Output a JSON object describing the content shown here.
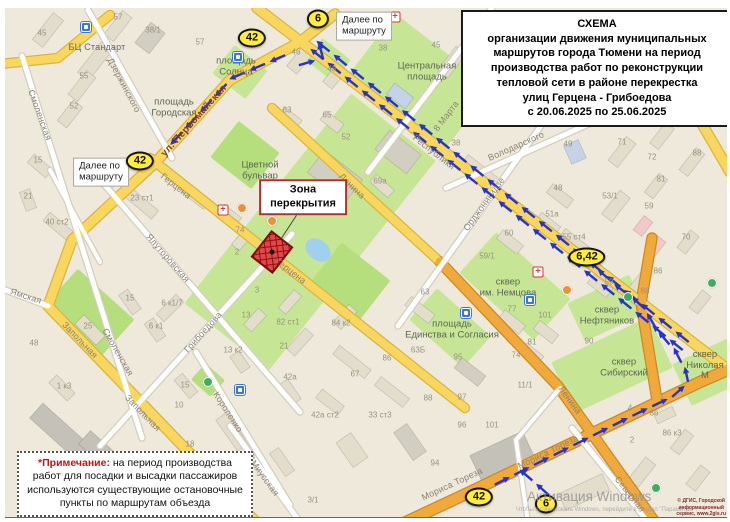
{
  "title_box": {
    "text": "СХЕМА\nорганизации движения муниципальных\nмаршрутов города Тюмени на период\nпроизводства работ по реконструкции\nтепловой сети в районе перекрестка\nулиц Герцена - Грибоедова\nс 20.06.2025 по 25.06.2025"
  },
  "note_box": {
    "label": "*Примечание:",
    "text": " на период производства работ для посадки и высадки пассажиров используются существующие остановочные пункты по маршрутам объезда"
  },
  "zone_label": {
    "text": "Зона\nперекрытия"
  },
  "watermark": {
    "line1": "Активация Windows",
    "line2": "Чтобы активировать Windows, перейдите в раздел \"Параметры\"."
  },
  "copyright": {
    "text": "© ДГИС, Городской\nинформационный\nсервис, www.2gis.ru"
  },
  "colors": {
    "route_blue": "#2633cc",
    "badge_yellow": "#ffec3d",
    "zone_red": "#e04848",
    "zone_hatch": "#8f0f0f",
    "road_yellow": "#f9d75e",
    "road_orange": "#f2a93c",
    "park_green": "#c6e696"
  },
  "route_badges": [
    {
      "t": "42",
      "x": 252,
      "y": 38
    },
    {
      "t": "6",
      "x": 318,
      "y": 19
    },
    {
      "t": "42",
      "x": 140,
      "y": 161
    },
    {
      "t": "6,42",
      "x": 587,
      "y": 257
    },
    {
      "t": "42",
      "x": 479,
      "y": 497
    },
    {
      "t": "6",
      "x": 546,
      "y": 504
    }
  ],
  "info_boxes": [
    {
      "t": "Далее по\nмаршруту",
      "x": 364,
      "y": 26
    },
    {
      "t": "Далее по\nмаршруту",
      "x": 101,
      "y": 172
    }
  ],
  "street_labels": [
    {
      "t": "Дзержинского",
      "x": 124,
      "y": 85,
      "rot": 62
    },
    {
      "t": "Смоленская",
      "x": 40,
      "y": 115,
      "rot": 70
    },
    {
      "t": "Смоленская",
      "x": 118,
      "y": 352,
      "rot": 60
    },
    {
      "t": "ул. Первомайская",
      "x": 194,
      "y": 121,
      "rot": -48,
      "cls": "main"
    },
    {
      "t": "Герцена",
      "x": 176,
      "y": 186,
      "rot": 38
    },
    {
      "t": "Герцена",
      "x": 291,
      "y": 271,
      "rot": 38
    },
    {
      "t": "Ялуторовская",
      "x": 168,
      "y": 258,
      "rot": 49
    },
    {
      "t": "Грибоедова",
      "x": 203,
      "y": 332,
      "rot": -48
    },
    {
      "t": "Короленко",
      "x": 228,
      "y": 412,
      "rot": 57
    },
    {
      "t": "Запольная",
      "x": 80,
      "y": 340,
      "rot": 46
    },
    {
      "t": "Запольная",
      "x": 143,
      "y": 413,
      "rot": 46
    },
    {
      "t": "Ямская",
      "x": 26,
      "y": 296,
      "rot": 18
    },
    {
      "t": "Республики",
      "x": 434,
      "y": 152,
      "rot": 38
    },
    {
      "t": "Ленина",
      "x": 352,
      "y": 186,
      "rot": 44
    },
    {
      "t": "Ленина",
      "x": 570,
      "y": 400,
      "rot": 54
    },
    {
      "t": "8 Марта",
      "x": 446,
      "y": 116,
      "rot": -53
    },
    {
      "t": "Орджоникидзе",
      "x": 484,
      "y": 204,
      "rot": -54
    },
    {
      "t": "Володарского",
      "x": 516,
      "y": 146,
      "rot": -24
    },
    {
      "t": "Мориса Тореза",
      "x": 452,
      "y": 484,
      "rot": -25
    },
    {
      "t": "Мориса Тореза",
      "x": 548,
      "y": 452,
      "rot": -26
    },
    {
      "t": "Северная",
      "x": 630,
      "y": 494,
      "rot": 51
    },
    {
      "t": "Миусская",
      "x": 265,
      "y": 478,
      "rot": 54
    },
    {
      "t": "БЦ Стандарт",
      "x": 97,
      "y": 47,
      "rot": 0,
      "cls": "poi-name"
    }
  ],
  "area_labels": [
    {
      "t": "площадь\nСолнца",
      "x": 236,
      "y": 67
    },
    {
      "t": "площадь\nГородская",
      "x": 174,
      "y": 108
    },
    {
      "t": "Центральная\nплощадь",
      "x": 427,
      "y": 72
    },
    {
      "t": "Цветной\nбульвар",
      "x": 260,
      "y": 171
    },
    {
      "t": "сквер\nим. Немцова",
      "x": 508,
      "y": 288
    },
    {
      "t": "площадь\nЕдинства и Согласия",
      "x": 452,
      "y": 330
    },
    {
      "t": "сквер\nНефтяников",
      "x": 607,
      "y": 316
    },
    {
      "t": "сквер\nСибирский",
      "x": 624,
      "y": 368
    },
    {
      "t": "сквер\nНиколая М",
      "x": 705,
      "y": 366
    }
  ],
  "house_numbers": [
    {
      "t": "45",
      "x": 42,
      "y": 33
    },
    {
      "t": "57",
      "x": 118,
      "y": 17
    },
    {
      "t": "38/1",
      "x": 153,
      "y": 30
    },
    {
      "t": "55",
      "x": 84,
      "y": 76
    },
    {
      "t": "52",
      "x": 74,
      "y": 106
    },
    {
      "t": "15",
      "x": 38,
      "y": 160
    },
    {
      "t": "34",
      "x": 101,
      "y": 174
    },
    {
      "t": "23 ст1",
      "x": 142,
      "y": 198
    },
    {
      "t": "40 ст2",
      "x": 57,
      "y": 222
    },
    {
      "t": "21",
      "x": 28,
      "y": 196
    },
    {
      "t": "25",
      "x": 88,
      "y": 326
    },
    {
      "t": "48",
      "x": 34,
      "y": 343
    },
    {
      "t": "1 к3",
      "x": 64,
      "y": 386
    },
    {
      "t": "15",
      "x": 130,
      "y": 298
    },
    {
      "t": "6 к1/7",
      "x": 172,
      "y": 303
    },
    {
      "t": "6 к1",
      "x": 156,
      "y": 326
    },
    {
      "t": "15",
      "x": 185,
      "y": 385
    },
    {
      "t": "10",
      "x": 179,
      "y": 405
    },
    {
      "t": "18",
      "x": 190,
      "y": 444
    },
    {
      "t": "57",
      "x": 200,
      "y": 42
    },
    {
      "t": "46",
      "x": 296,
      "y": 52
    },
    {
      "t": "48",
      "x": 332,
      "y": 69
    },
    {
      "t": "63",
      "x": 287,
      "y": 110
    },
    {
      "t": "65",
      "x": 327,
      "y": 115
    },
    {
      "t": "38",
      "x": 383,
      "y": 48
    },
    {
      "t": "45",
      "x": 436,
      "y": 45
    },
    {
      "t": "52",
      "x": 346,
      "y": 137
    },
    {
      "t": "69а",
      "x": 380,
      "y": 181
    },
    {
      "t": "38",
      "x": 456,
      "y": 143
    },
    {
      "t": "49",
      "x": 568,
      "y": 144
    },
    {
      "t": "71",
      "x": 622,
      "y": 142
    },
    {
      "t": "71",
      "x": 705,
      "y": 123
    },
    {
      "t": "72",
      "x": 652,
      "y": 157
    },
    {
      "t": "88",
      "x": 697,
      "y": 153
    },
    {
      "t": "81",
      "x": 661,
      "y": 179
    },
    {
      "t": "53/1",
      "x": 610,
      "y": 196
    },
    {
      "t": "59",
      "x": 649,
      "y": 206
    },
    {
      "t": "70",
      "x": 686,
      "y": 237
    },
    {
      "t": "48",
      "x": 558,
      "y": 188
    },
    {
      "t": "51а",
      "x": 552,
      "y": 214
    },
    {
      "t": "55 ст4",
      "x": 574,
      "y": 237
    },
    {
      "t": "60",
      "x": 509,
      "y": 233
    },
    {
      "t": "59/1",
      "x": 487,
      "y": 256
    },
    {
      "t": "59",
      "x": 609,
      "y": 282
    },
    {
      "t": "86",
      "x": 658,
      "y": 271
    },
    {
      "t": "88",
      "x": 645,
      "y": 291
    },
    {
      "t": "90",
      "x": 589,
      "y": 341
    },
    {
      "t": "74",
      "x": 240,
      "y": 230
    },
    {
      "t": "2",
      "x": 237,
      "y": 252
    },
    {
      "t": "3",
      "x": 257,
      "y": 290
    },
    {
      "t": "74",
      "x": 516,
      "y": 355
    },
    {
      "t": "77",
      "x": 512,
      "y": 309
    },
    {
      "t": "101",
      "x": 545,
      "y": 315
    },
    {
      "t": "81",
      "x": 532,
      "y": 342
    },
    {
      "t": "63",
      "x": 425,
      "y": 292
    },
    {
      "t": "63Б",
      "x": 418,
      "y": 350
    },
    {
      "t": "95",
      "x": 458,
      "y": 357
    },
    {
      "t": "96",
      "x": 462,
      "y": 425
    },
    {
      "t": "97",
      "x": 462,
      "y": 397
    },
    {
      "t": "101",
      "x": 492,
      "y": 425
    },
    {
      "t": "11/1",
      "x": 525,
      "y": 385
    },
    {
      "t": "67",
      "x": 355,
      "y": 374
    },
    {
      "t": "86",
      "x": 387,
      "y": 358
    },
    {
      "t": "88",
      "x": 428,
      "y": 398
    },
    {
      "t": "33 ст3",
      "x": 380,
      "y": 415
    },
    {
      "t": "42а ст2",
      "x": 325,
      "y": 415
    },
    {
      "t": "42а",
      "x": 290,
      "y": 377
    },
    {
      "t": "21",
      "x": 284,
      "y": 346
    },
    {
      "t": "82 ст1",
      "x": 288,
      "y": 322
    },
    {
      "t": "84 к2",
      "x": 341,
      "y": 323
    },
    {
      "t": "13",
      "x": 246,
      "y": 315
    },
    {
      "t": "13 к2",
      "x": 233,
      "y": 350
    },
    {
      "t": "4",
      "x": 253,
      "y": 457
    },
    {
      "t": "94",
      "x": 435,
      "y": 463
    },
    {
      "t": "3/1",
      "x": 313,
      "y": 500
    },
    {
      "t": "86 к3",
      "x": 672,
      "y": 433
    },
    {
      "t": "86",
      "x": 654,
      "y": 413
    },
    {
      "t": "2",
      "x": 632,
      "y": 440
    },
    {
      "t": "1",
      "x": 662,
      "y": 397
    },
    {
      "t": "4",
      "x": 630,
      "y": 408
    }
  ],
  "poi_icons": [
    {
      "type": "hospital",
      "x": 395,
      "y": 17
    },
    {
      "type": "hospital",
      "x": 223,
      "y": 210
    },
    {
      "type": "hospital",
      "x": 538,
      "y": 272
    },
    {
      "type": "transport",
      "x": 86,
      "y": 27
    },
    {
      "type": "transport",
      "x": 238,
      "y": 57
    },
    {
      "type": "transport",
      "x": 530,
      "y": 300
    },
    {
      "type": "transport",
      "x": 466,
      "y": 313
    },
    {
      "type": "transport",
      "x": 240,
      "y": 390
    },
    {
      "type": "park-poi",
      "x": 208,
      "y": 382
    },
    {
      "type": "park-poi",
      "x": 628,
      "y": 297
    },
    {
      "type": "park-poi",
      "x": 712,
      "y": 283
    },
    {
      "type": "park-poi",
      "x": 656,
      "y": 488
    },
    {
      "type": "cafe",
      "x": 242,
      "y": 208
    },
    {
      "type": "cafe",
      "x": 272,
      "y": 221
    },
    {
      "type": "cafe",
      "x": 567,
      "y": 290
    }
  ]
}
